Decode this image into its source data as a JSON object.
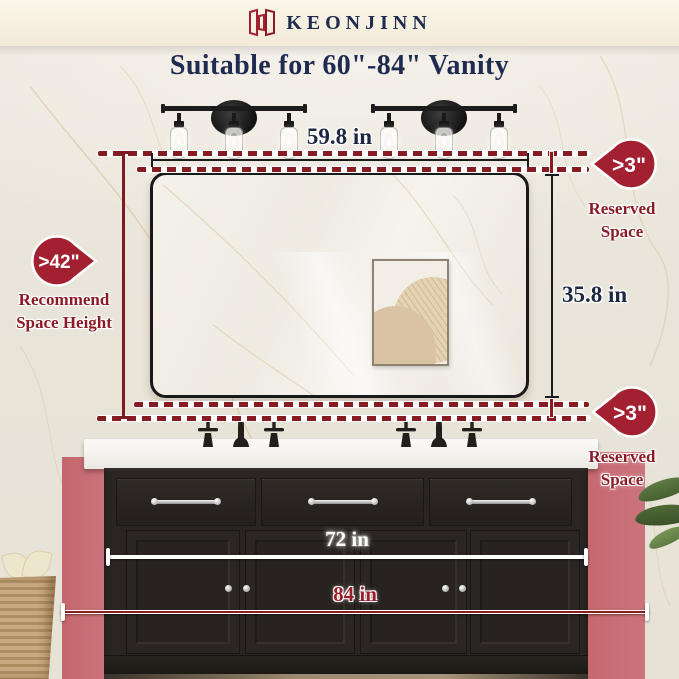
{
  "brand": {
    "name": "KEONJINN"
  },
  "headline": "Suitable for 60\"-84\" Vanity",
  "measurements": {
    "mirror_width": "59.8 in",
    "mirror_height": "35.8 in",
    "recommended_vanity_width": "72 in",
    "max_vanity_width": "84 in"
  },
  "callouts": {
    "space_height": {
      "value": ">42\"",
      "line1": "Recommend",
      "line2": "Space Height"
    },
    "reserved_top": {
      "value": ">3\"",
      "line1": "Reserved",
      "line2": "Space"
    },
    "reserved_bottom": {
      "value": ">3\"",
      "line1": "Reserved",
      "line2": "Space"
    }
  },
  "colors": {
    "badge_red": "#A32031",
    "label_dark_red": "#8C1B26",
    "dash_red": "#861B22",
    "navy_text": "#1F2C50",
    "pink_wall": "#C97179",
    "cabinet_black": "#2A2522",
    "counter_white": "#F6F5F2",
    "wall_cream": "#E9E4D9"
  }
}
